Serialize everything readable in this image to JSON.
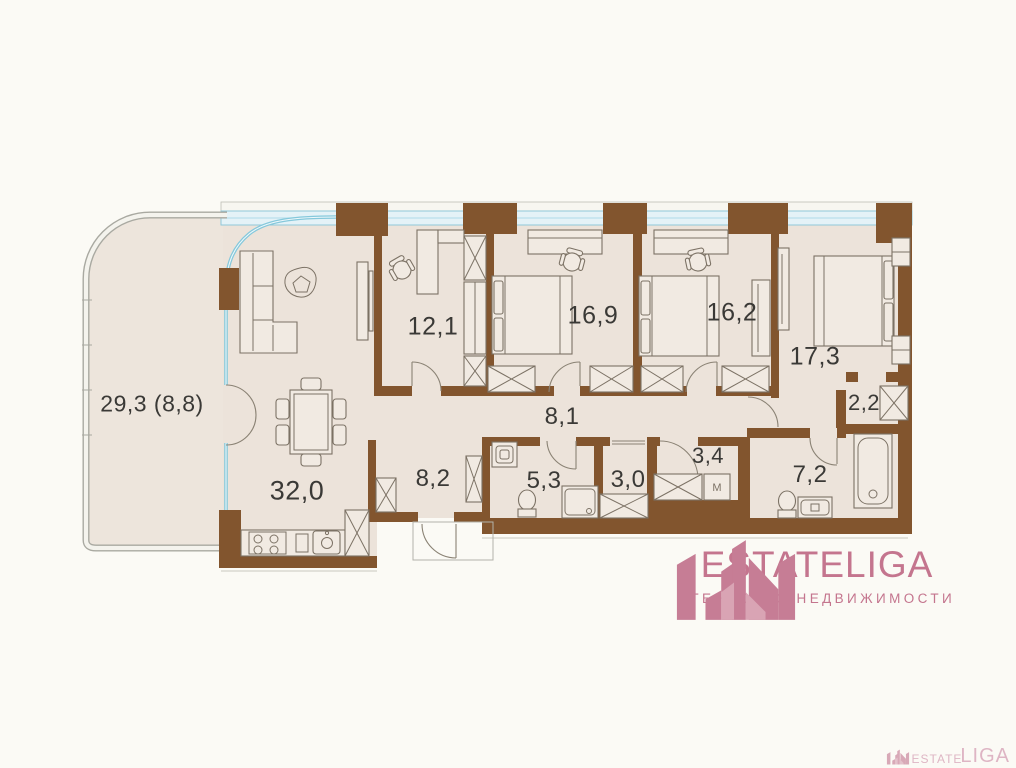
{
  "plan": {
    "rooms": [
      {
        "id": "terrace",
        "label": "29,3 (8,8)",
        "x": 152,
        "y": 404,
        "fs": 23
      },
      {
        "id": "living-kitchen",
        "label": "32,0",
        "x": 297,
        "y": 491,
        "fs": 27
      },
      {
        "id": "study",
        "label": "12,1",
        "x": 433,
        "y": 327,
        "fs": 25
      },
      {
        "id": "bedroom-1",
        "label": "16,9",
        "x": 593,
        "y": 316,
        "fs": 25
      },
      {
        "id": "bedroom-2",
        "label": "16,2",
        "x": 732,
        "y": 313,
        "fs": 25
      },
      {
        "id": "bedroom-3",
        "label": "17,3",
        "x": 815,
        "y": 357,
        "fs": 25
      },
      {
        "id": "corridor",
        "label": "8,1",
        "x": 562,
        "y": 417,
        "fs": 24
      },
      {
        "id": "hallway",
        "label": "8,2",
        "x": 433,
        "y": 479,
        "fs": 24
      },
      {
        "id": "bathroom-1",
        "label": "5,3",
        "x": 544,
        "y": 481,
        "fs": 24
      },
      {
        "id": "storage",
        "label": "3,0",
        "x": 628,
        "y": 480,
        "fs": 24
      },
      {
        "id": "vestibule",
        "label": "3,4",
        "x": 708,
        "y": 456,
        "fs": 22
      },
      {
        "id": "wardrobe",
        "label": "2,2",
        "x": 864,
        "y": 403,
        "fs": 22
      },
      {
        "id": "bathroom-2",
        "label": "7,2",
        "x": 810,
        "y": 475,
        "fs": 24
      }
    ],
    "washer_symbol": "М"
  },
  "branding": {
    "logo_text": "ESTATELIGA",
    "tagline": "АГЕНТСТВО НЕДВИЖИМОСТИ"
  },
  "watermark": {
    "text_small": "ESTATE",
    "text_large": "LIGA"
  },
  "colors": {
    "brand_pink": "#c4758e",
    "wall_brown": "#82552e",
    "glass_blue": "#8ecfe0",
    "floor_beige": "#ece3da"
  }
}
